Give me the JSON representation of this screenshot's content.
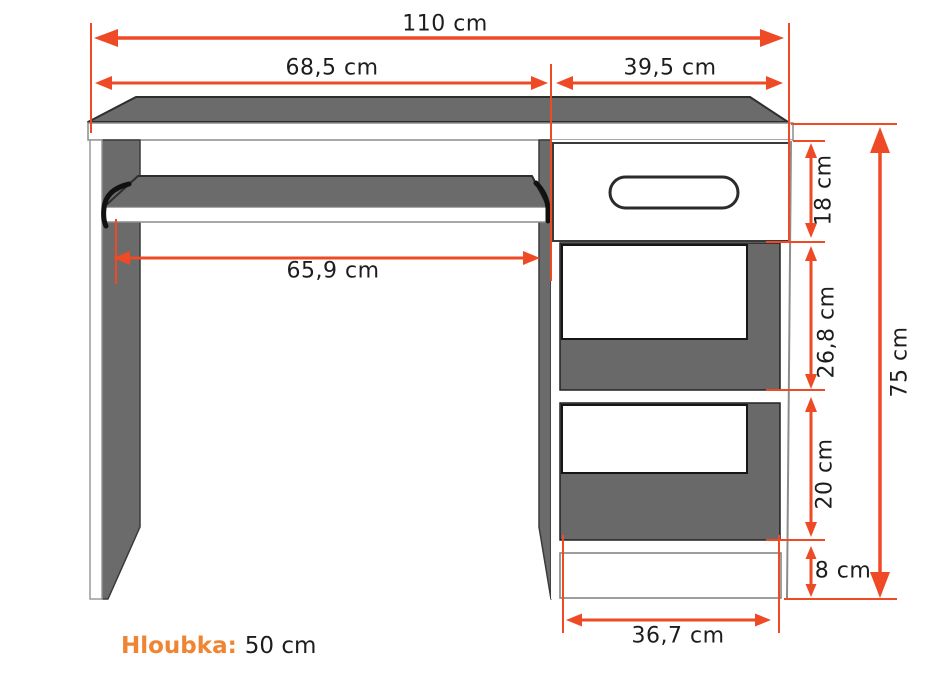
{
  "diagram": {
    "kind": "furniture dimension drawing",
    "subject": "computer desk with keyboard tray, drawer and open shelves"
  },
  "dimensions": {
    "total_width": "110 cm",
    "top_left_section": "68,5 cm",
    "top_right_section": "39,5 cm",
    "keyboard_tray_width": "65,9 cm",
    "drawer_height": "18 cm",
    "upper_shelf_height": "26,8 cm",
    "lower_shelf_height": "20 cm",
    "plinth_height": "8 cm",
    "total_height": "75 cm",
    "cabinet_bottom_width": "36,7 cm"
  },
  "depth_note": {
    "label": "Hloubka:",
    "value": "50 cm"
  },
  "colors": {
    "dimension_accent": "#ee4a26",
    "depth_label_orange": "#ef8532",
    "panel_gray": "#6b6b6b",
    "text": "#1d1d1d"
  }
}
